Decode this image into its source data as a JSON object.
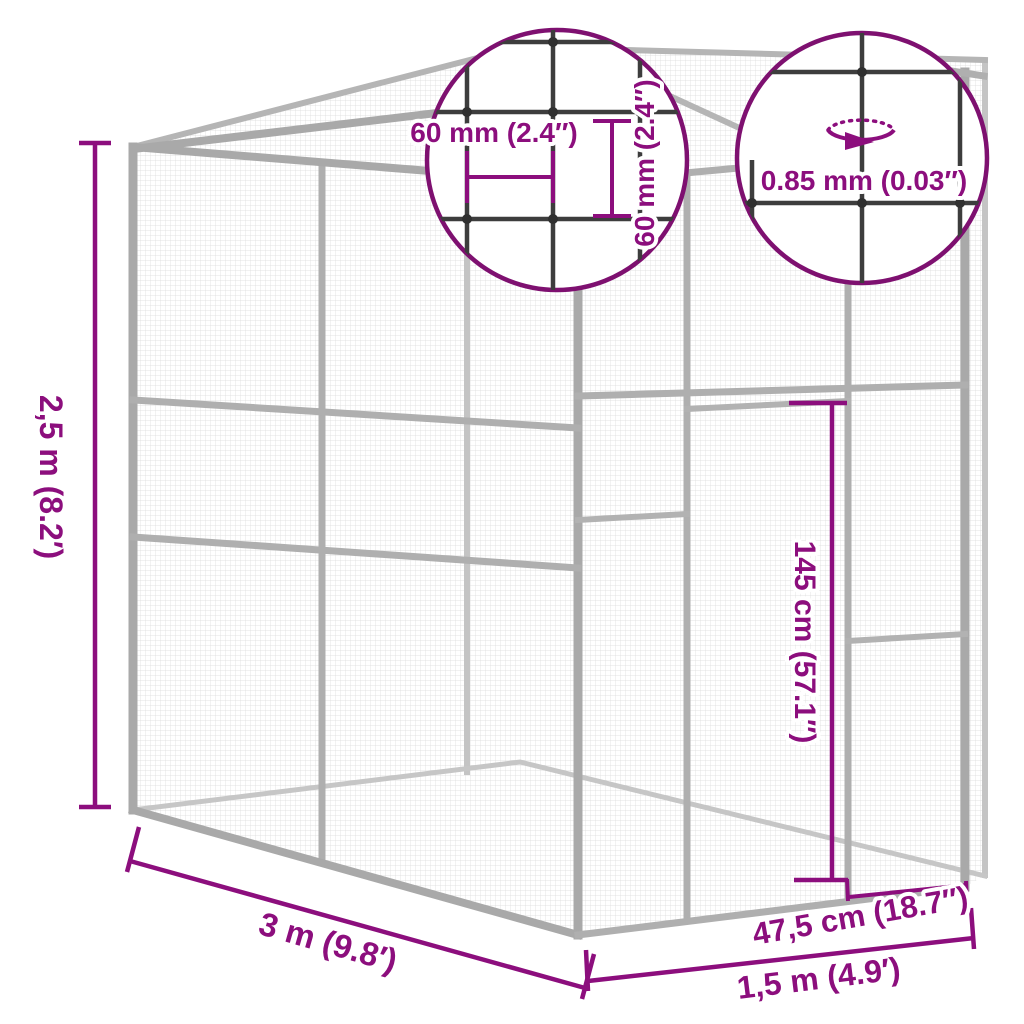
{
  "figure": {
    "type": "product-dimension-diagram",
    "subject": "outdoor mesh cat enclosure with sloped roof and side door"
  },
  "colors": {
    "dimension": "#8C0E7D",
    "detail_circle_stroke": "#7E1070",
    "frame": "#A9A9A9",
    "frame_light": "#C4C4C4",
    "wire": "#3D3D3D",
    "mesh": "#DADADA",
    "background": "#FFFFFF"
  },
  "dimensions": {
    "height": {
      "label": "2,5 m (8.2′)"
    },
    "length": {
      "label": "3 m (9.8′)"
    },
    "depth": {
      "label": "1,5 m (4.9′)"
    },
    "side_panel_width": {
      "label": "47,5 cm (18.7″)"
    },
    "door_height": {
      "label": "145 cm (57.1″)"
    }
  },
  "detail_circles": {
    "mesh_pitch": {
      "horizontal": {
        "label": "60 mm (2.4″)"
      },
      "vertical": {
        "label": "60 mm (2.4″)"
      }
    },
    "wire_gauge": {
      "label": "0.85 mm (0.03″)",
      "icon": "rotation-arrow"
    }
  }
}
